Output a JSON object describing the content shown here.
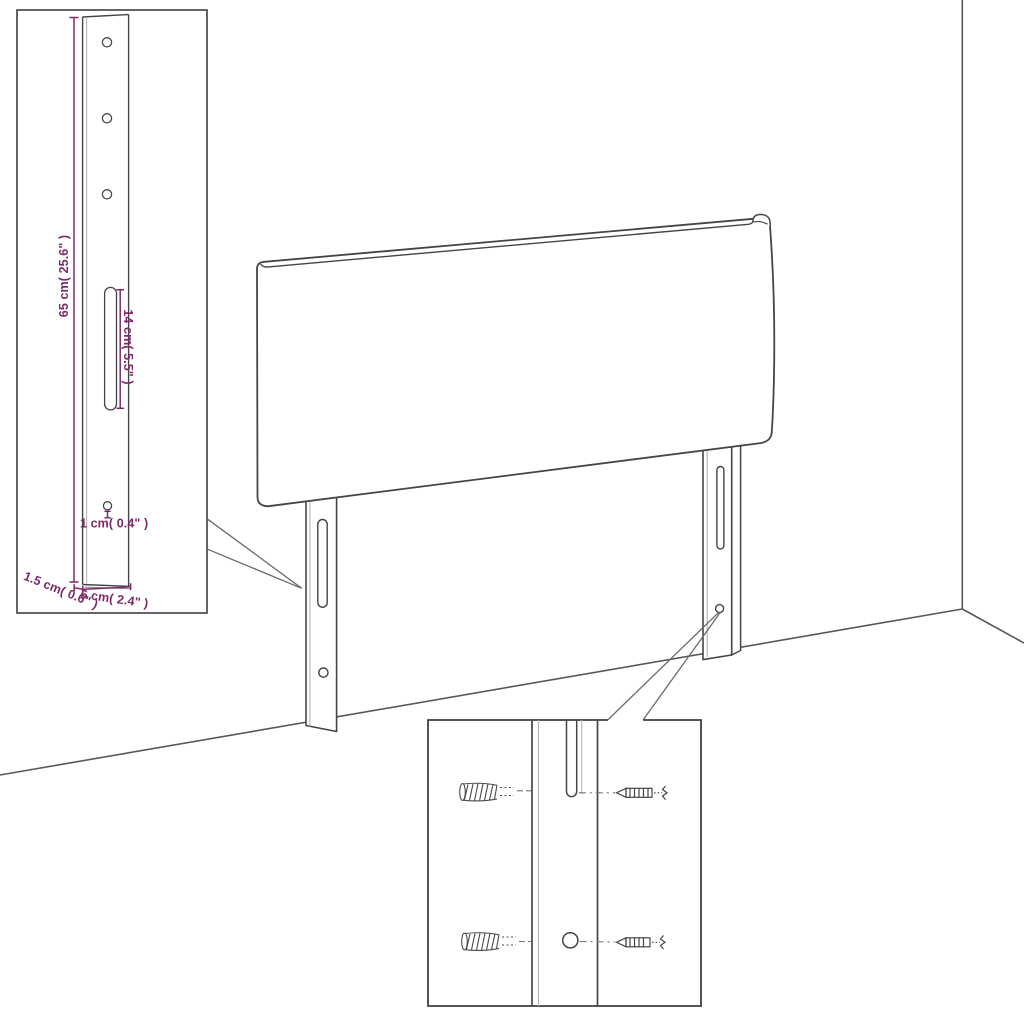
{
  "diagram": {
    "type": "furniture-assembly-instruction",
    "subject": "upholstered headboard with two mounting legs, wall corner background",
    "colors": {
      "background": "#ffffff",
      "outline": "#454545",
      "wall_line": "#585858",
      "highlight_line": "#b8b8b8",
      "dimension_accent": "#7e2a6a",
      "hatch": "#4a4a4a"
    },
    "labels": {
      "height": "65 cm( 25.6\" )",
      "slot_length": "14 cm( 5.5\" )",
      "hole_diameter": "1 cm( 0.4\" )",
      "thickness": "1.5 cm( 0.6\" )",
      "width": "6 cm( 2.4\" )"
    },
    "insets": {
      "bracket_detail": "leg bracket with 3 holes, long slot and bottom hole, dimension callouts",
      "mounting_detail": "wall plugs and screws aligned to leg slot and hole"
    }
  }
}
